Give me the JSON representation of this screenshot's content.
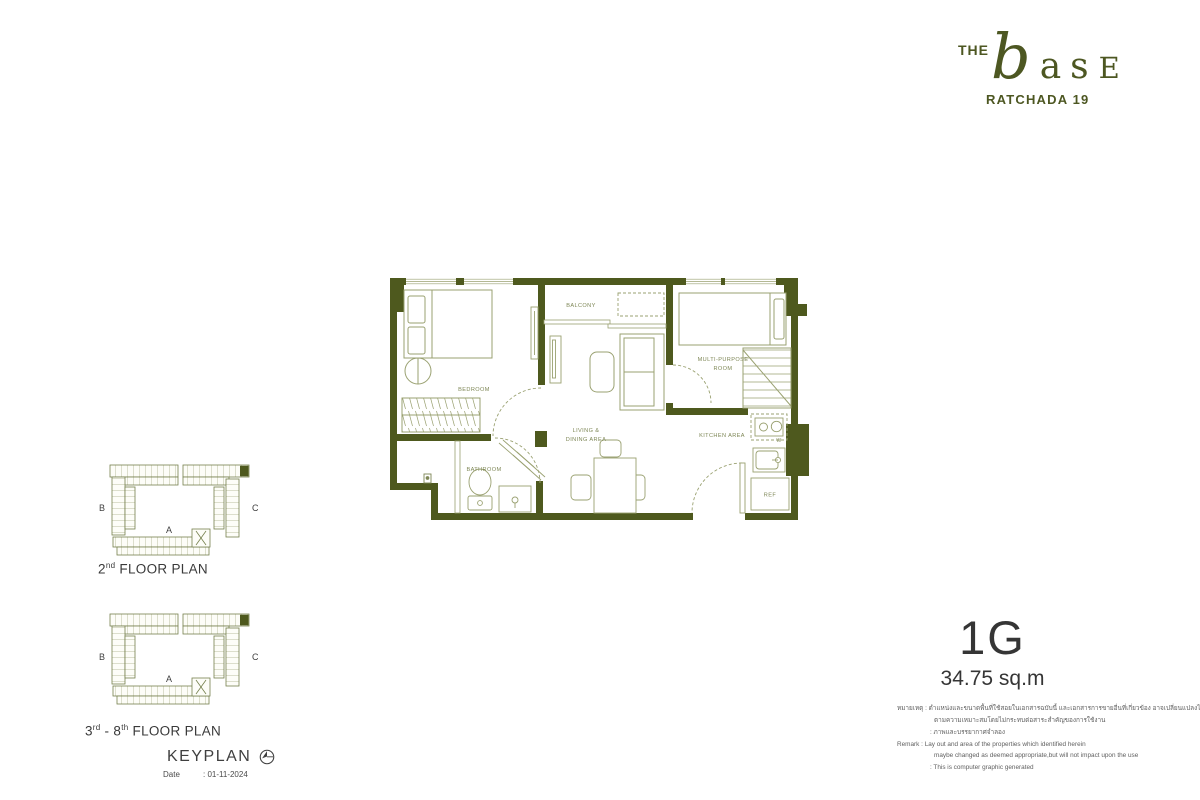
{
  "brand": {
    "the": "THE",
    "b": "b",
    "a": "a",
    "s": "s",
    "e": "E",
    "subtitle": "RATCHADA 19"
  },
  "unit": {
    "code": "1G",
    "area": "34.75 sq.m"
  },
  "rooms": {
    "bedroom": "BEDROOM",
    "balcony": "BALCONY",
    "living1": "LIVING &",
    "living2": "DINING AREA",
    "multi1": "MULTI-PURPOSE",
    "multi2": "ROOM",
    "kitchen": "KITCHEN AREA",
    "bathroom": "BATHROOM",
    "ref": "REF",
    "w": "W"
  },
  "keyplan": {
    "wing_a": "A",
    "wing_b": "B",
    "wing_c": "C",
    "plan2": {
      "p1": "2",
      "s1": "nd",
      "p2": " FLOOR PLAN"
    },
    "plan38": {
      "p1": "3",
      "s1": "rd",
      "p2": " - 8",
      "s2": "th",
      "p3": " FLOOR PLAN"
    },
    "title": "KEYPLAN",
    "date_label": "Date",
    "date_value": ": 01-11-2024"
  },
  "remark": {
    "th1": "หมายเหตุ : ตำแหน่งและขนาดพื้นที่ใช้สอยในเอกสารฉบับนี้ และเอกสารการขายอื่นที่เกี่ยวข้อง อาจเปลี่ยนแปลงได้",
    "th2": "ตามความเหมาะสมโดยไม่กระทบต่อสาระสำคัญของการใช้งาน",
    "th3": ": ภาพและบรรยากาศจำลอง",
    "en1": "Remark : Lay out and area of the properties which identified herein",
    "en2": "maybe changed as deemed appropriate,but will not impact upon the use",
    "en3": ": This is computer graphic generated"
  },
  "colors": {
    "wall_olive": "#4e591e",
    "line_sage": "#9aa171",
    "label_green": "#7e8756",
    "ink": "#353535",
    "remark_gray": "#5f5f5f"
  }
}
